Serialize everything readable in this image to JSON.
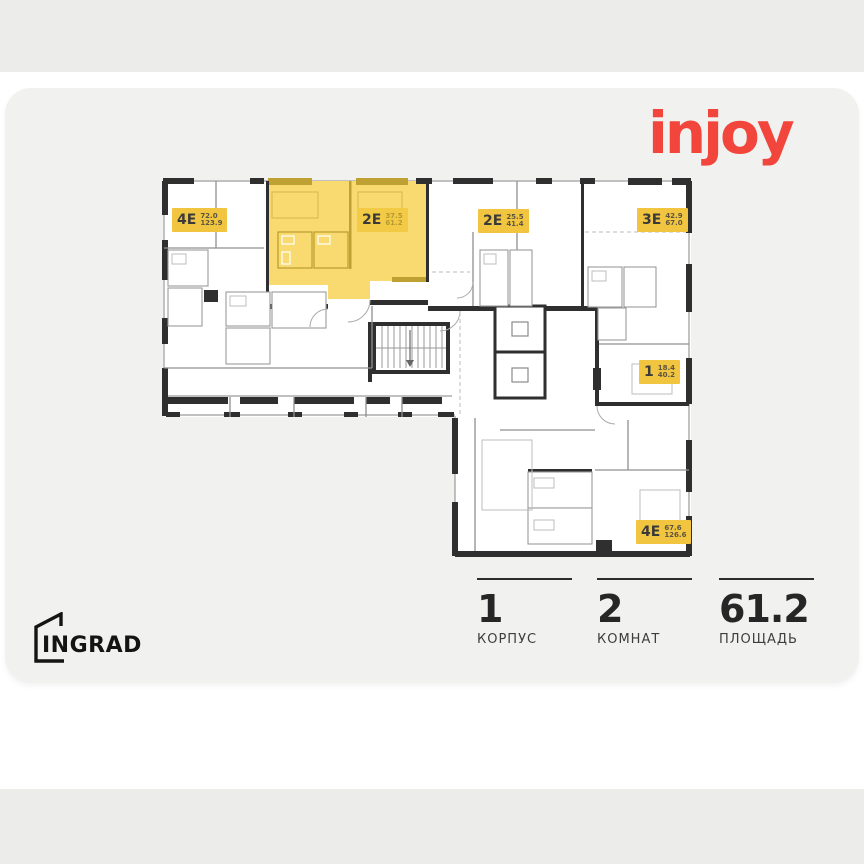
{
  "page": {
    "top_strip_color": "#ececeb",
    "card_color": "#f1f1f0",
    "plan_bg": "#ffffff"
  },
  "brand": {
    "developer_project_logo": "injoy",
    "developer_project_logo_color": "#f2453b",
    "developer_logo": "INGRAD"
  },
  "floorplan": {
    "highlight_fill": "#f8da70",
    "badge_bg": "#f2c540",
    "wall_color": "#2f2f2f",
    "units": [
      {
        "id": "unit-4e-left",
        "label": "4Е",
        "area_living": "72.0",
        "area_total": "123.9",
        "highlighted": false
      },
      {
        "id": "unit-2e-selected",
        "label": "2Е",
        "area_living": "37.5",
        "area_total": "61.2",
        "highlighted": true
      },
      {
        "id": "unit-2e-middle",
        "label": "2Е",
        "area_living": "25.5",
        "area_total": "41.4",
        "highlighted": false
      },
      {
        "id": "unit-3e",
        "label": "3Е",
        "area_living": "42.9",
        "area_total": "67.0",
        "highlighted": false
      },
      {
        "id": "unit-1",
        "label": "1",
        "area_living": "18.4",
        "area_total": "40.2",
        "highlighted": false
      },
      {
        "id": "unit-4e-bottom",
        "label": "4Е",
        "area_living": "67.6",
        "area_total": "126.6",
        "highlighted": false
      }
    ]
  },
  "summary": [
    {
      "value": "1",
      "label": "КОРПУС"
    },
    {
      "value": "2",
      "label": "КОМНАТ"
    },
    {
      "value": "61.2",
      "label": "ПЛОЩАДЬ"
    }
  ]
}
